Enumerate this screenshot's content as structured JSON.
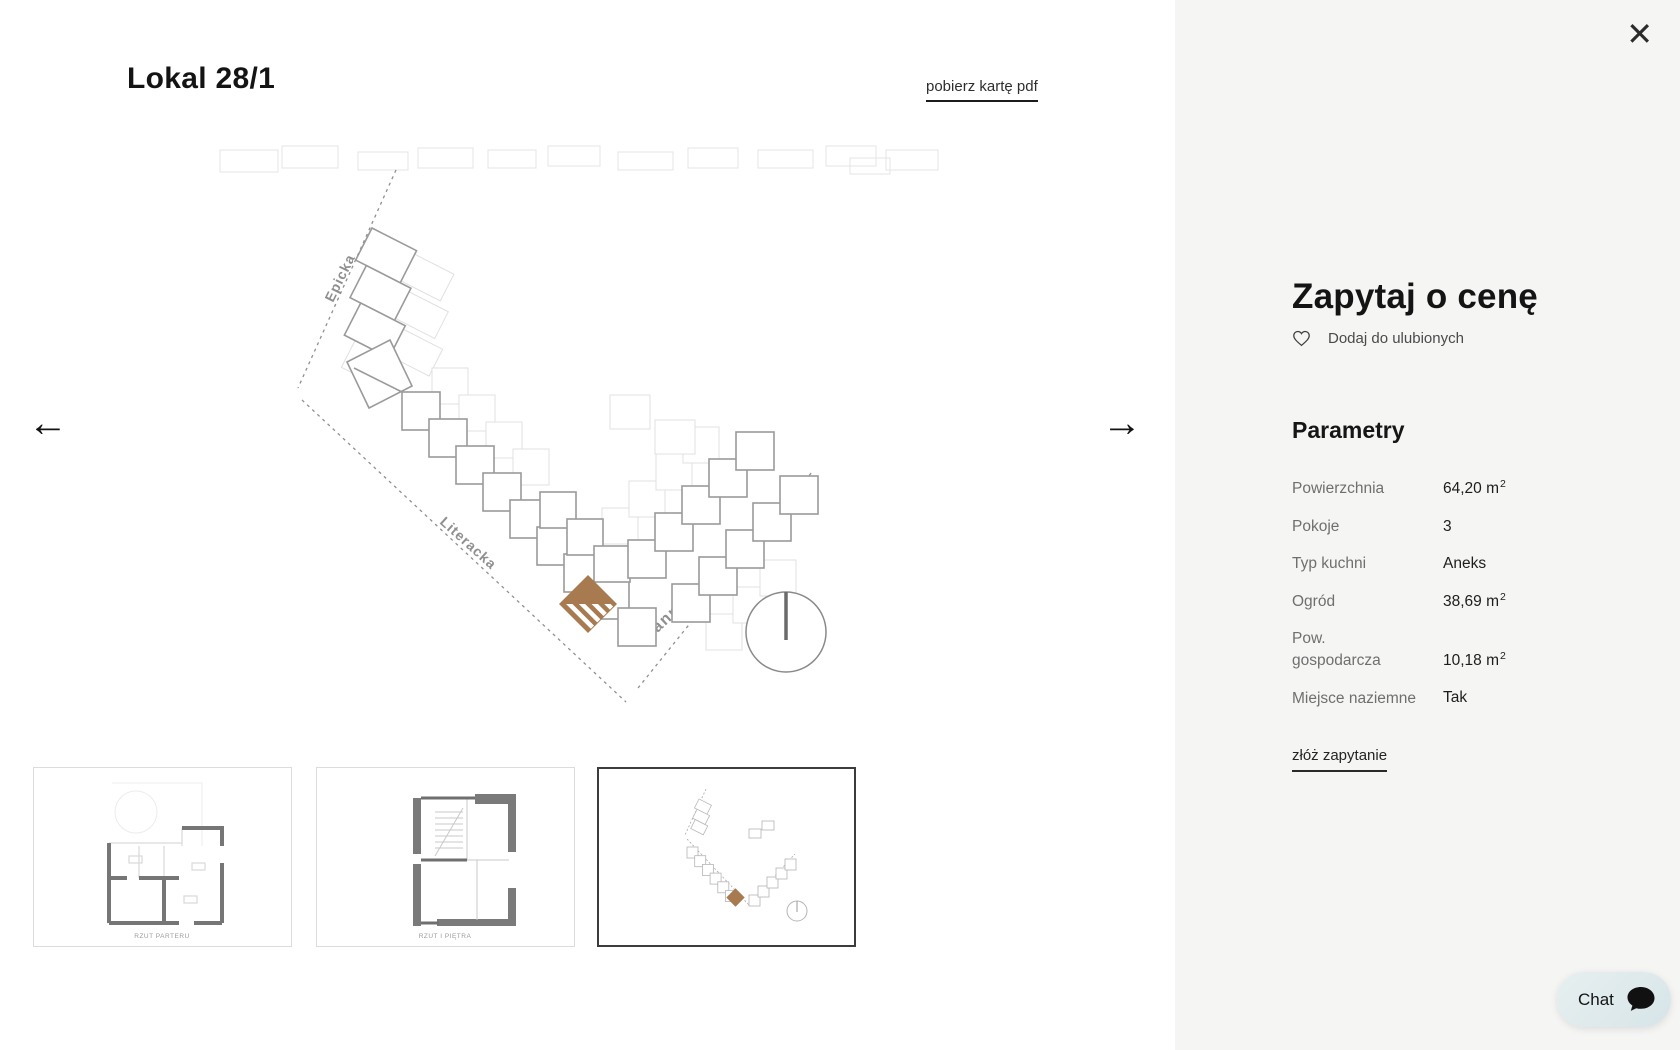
{
  "modal": {
    "title": "Lokal 28/1",
    "pdf_link": "pobierz kartę pdf",
    "close_icon": "✕",
    "prev_arrow": "←",
    "next_arrow": "→"
  },
  "site_plan": {
    "streets": {
      "street_1": "Epicka",
      "street_2": "Literacka",
      "street_3": "Hanny Malewskiej"
    },
    "highlight_color": "#a87a50"
  },
  "thumbnails": [
    {
      "caption": "RZUT PARTERU",
      "selected": false
    },
    {
      "caption": "RZUT I PIĘTRA",
      "selected": false
    },
    {
      "caption": "",
      "selected": true
    }
  ],
  "panel": {
    "heading": "Zapytaj o cenę",
    "favorites_label": "Dodaj do ulubionych",
    "section_title": "Parametry",
    "rows": [
      {
        "label": "Powierzchnia",
        "value": "64,20 m",
        "sup": "2"
      },
      {
        "label": "Pokoje",
        "value": "3",
        "sup": ""
      },
      {
        "label": "Typ kuchni",
        "value": "Aneks",
        "sup": ""
      },
      {
        "label": "Ogród",
        "value": "38,69 m",
        "sup": "2"
      },
      {
        "label": "Pow.\ngospodarcza",
        "value": "10,18 m",
        "sup": "2"
      },
      {
        "label": "Miejsce naziemne",
        "value": "Tak",
        "sup": ""
      }
    ],
    "inquiry_link": "złóż zapytanie"
  },
  "chat": {
    "label": "Chat"
  },
  "colors": {
    "panel_bg": "#f5f5f4",
    "accent_brown": "#a87a50",
    "chat_bg": "#dde9eb"
  }
}
